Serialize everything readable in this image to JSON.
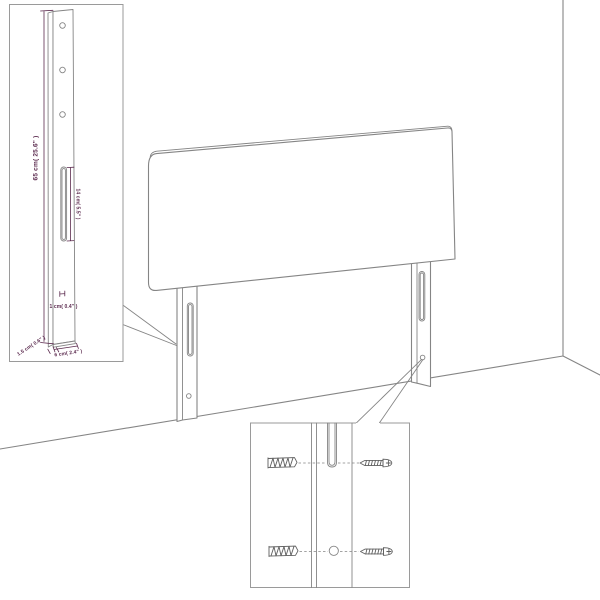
{
  "colors": {
    "line": "#858585",
    "line_dark": "#5f5f5f",
    "box_border": "#9a9a9a",
    "label": "#5b2a4e",
    "background": "#ffffff"
  },
  "diagram": {
    "subject": "upholstered headboard with two mounting legs shown against a room corner",
    "insets": {
      "leg_dimensions": "close-up of one leg with drill holes, slot and dimension labels",
      "mounting_hardware": "close-up of leg slot and hole with wall plugs and screws"
    }
  },
  "annotations": {
    "leg_height": "65 cm( 25.6\" )",
    "slot_length": "14 cm( 5.5\" )",
    "slot_width": "1 cm( 0.4\" )",
    "leg_depth": "1.5 cm( 0.6\" )",
    "leg_width": "6 cm( 2.4\" )"
  }
}
